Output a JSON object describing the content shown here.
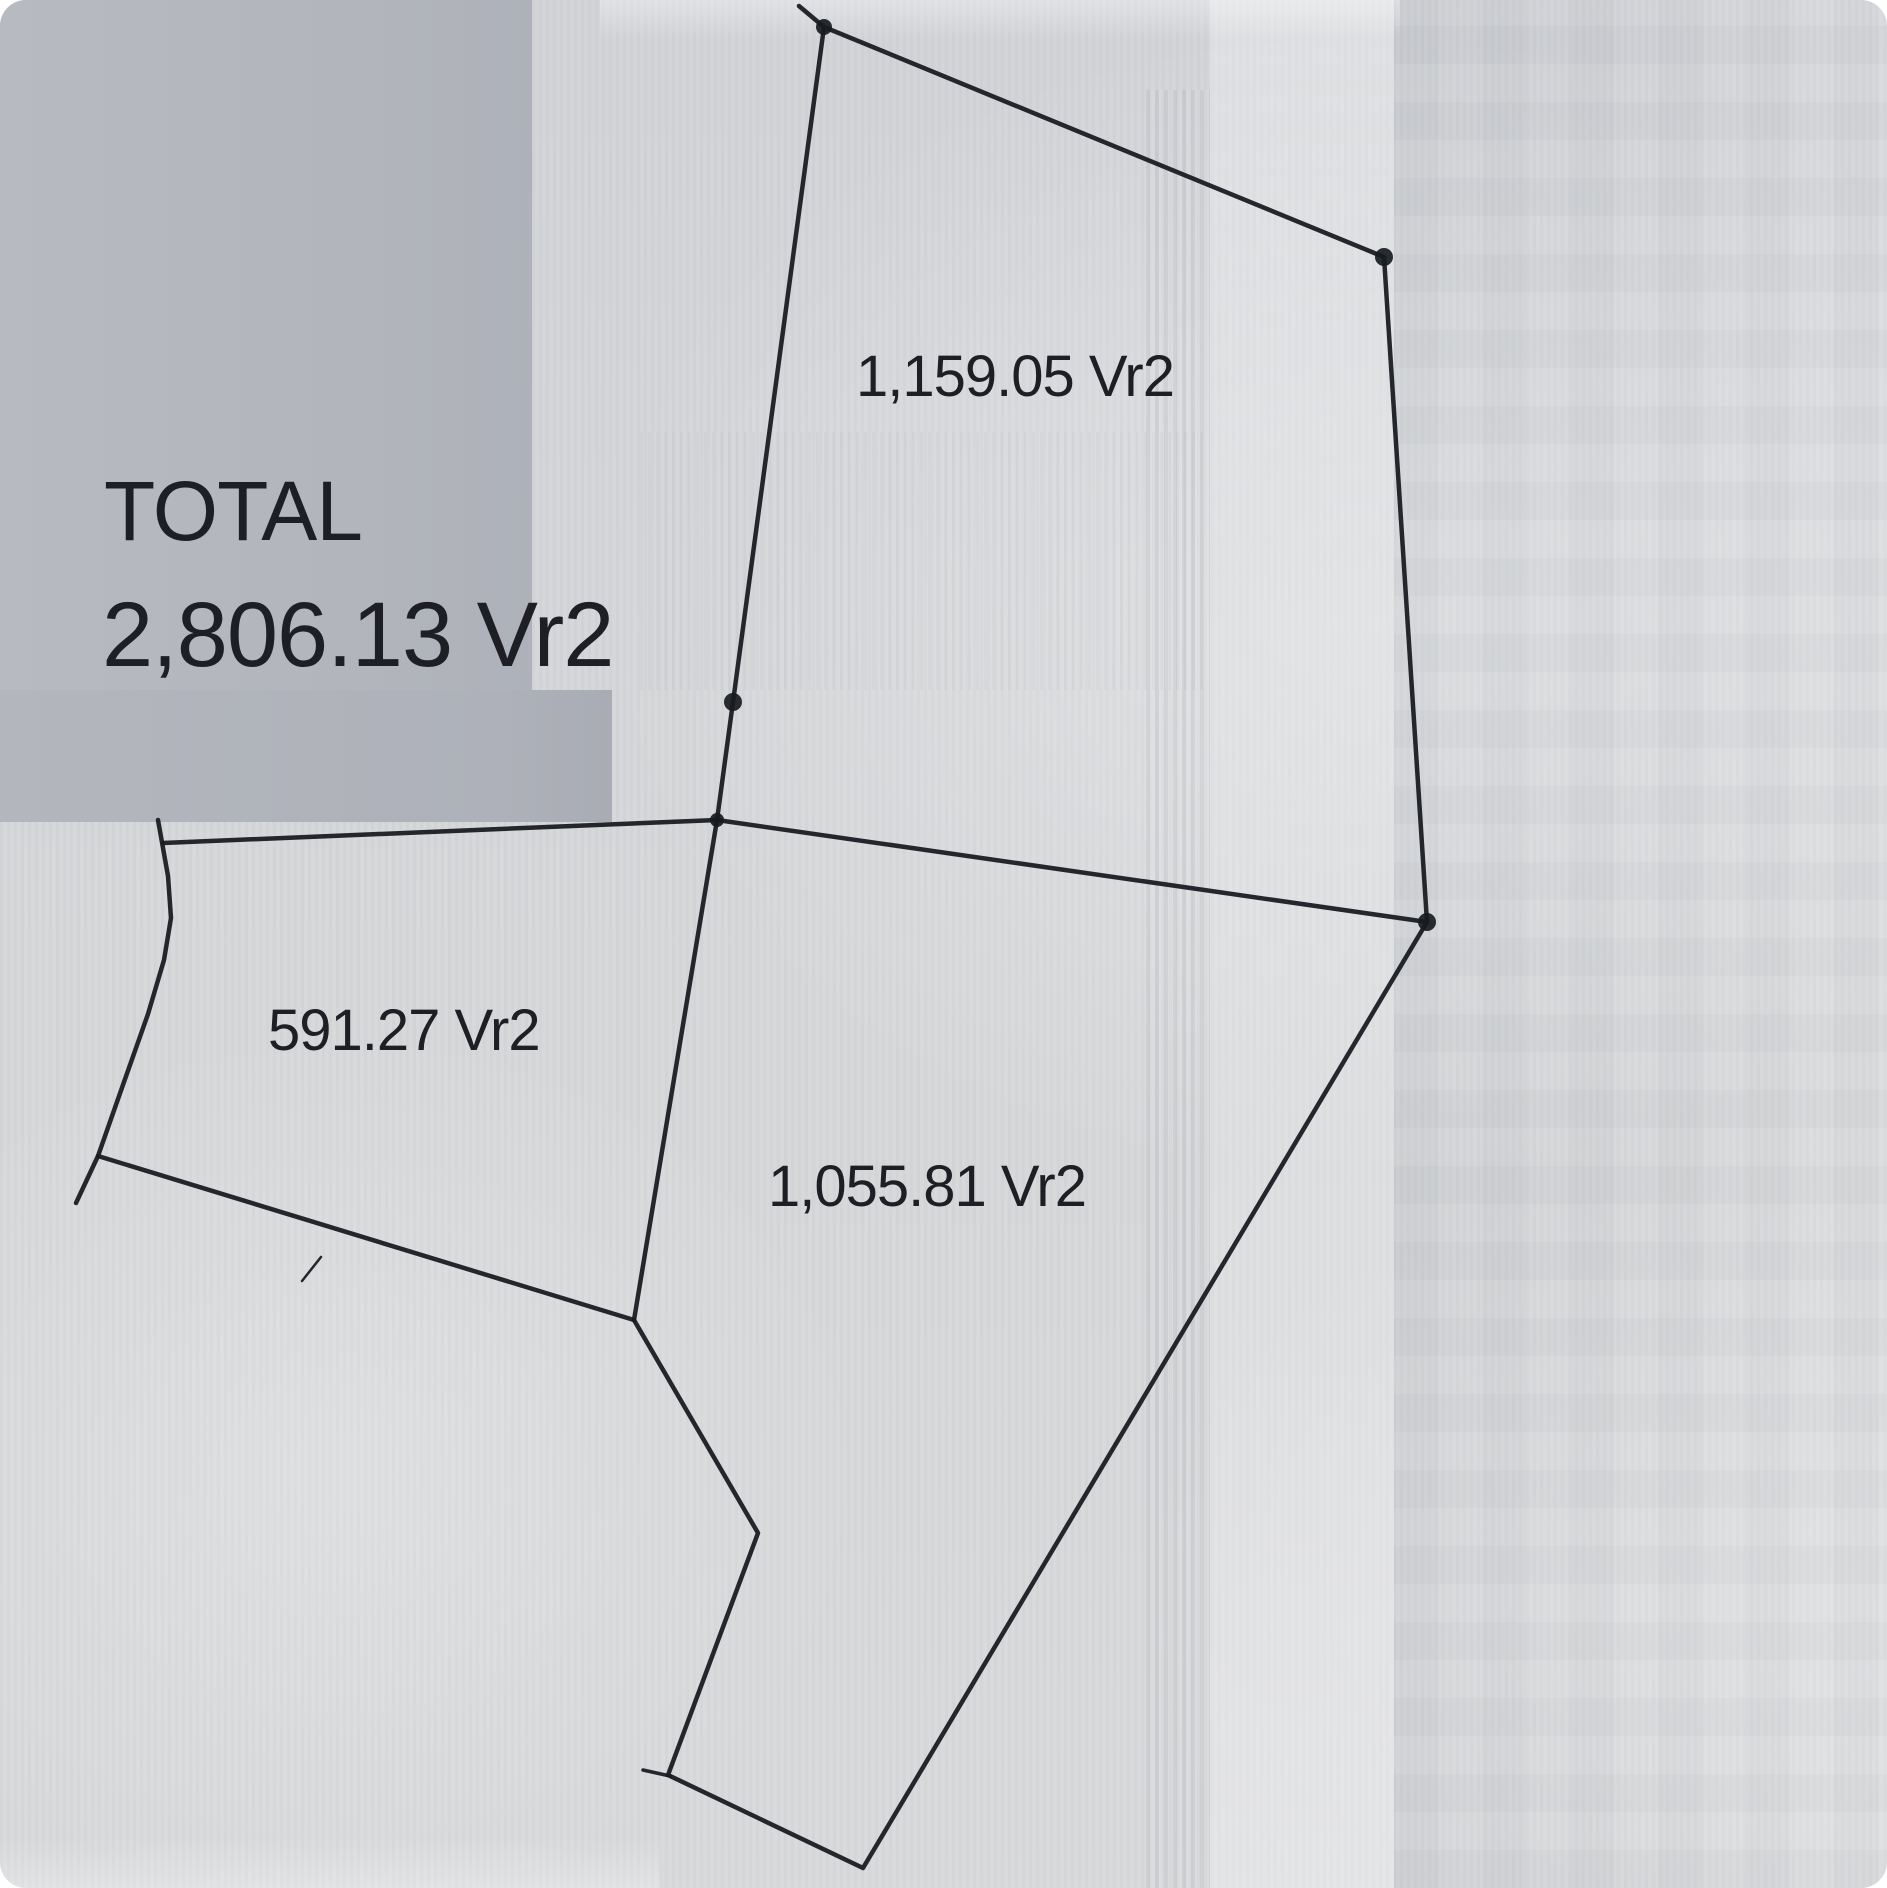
{
  "page_title": "Land survey plat with parcel areas",
  "units": "Vr2",
  "total": {
    "label": "TOTAL",
    "value": "2,806.13 Vr2",
    "area": 2806.13
  },
  "parcels": [
    {
      "id": "north-parcel",
      "area_label": "1,159.05 Vr2",
      "area": 1159.05
    },
    {
      "id": "west-parcel",
      "area_label": "591.27 Vr2",
      "area": 591.27
    },
    {
      "id": "south-parcel",
      "area_label": "1,055.81 Vr2",
      "area": 1055.81
    }
  ],
  "colors": {
    "ink": "#181b21",
    "text": "#1d1f24",
    "paper": "#d5d7d9",
    "patch_gray": "#b2b5bc"
  },
  "survey": {
    "stroke_width": 4.5,
    "polylines": [
      {
        "name": "north-parcel-top-edge",
        "points": [
          [
            799,
            6
          ],
          [
            824,
            27
          ],
          [
            1384,
            257
          ]
        ]
      },
      {
        "name": "north-parcel-right-edge",
        "points": [
          [
            1384,
            257
          ],
          [
            1427,
            922
          ]
        ]
      },
      {
        "name": "north-parcel-left-edge",
        "points": [
          [
            824,
            27
          ],
          [
            733,
            702
          ],
          [
            717,
            820
          ]
        ]
      },
      {
        "name": "mid-horizontal-boundary",
        "points": [
          [
            163,
            843
          ],
          [
            717,
            820
          ],
          [
            1427,
            922
          ]
        ]
      },
      {
        "name": "mid-vertical-boundary",
        "points": [
          [
            717,
            820
          ],
          [
            634,
            1320
          ]
        ]
      },
      {
        "name": "west-curved-boundary",
        "points": [
          [
            158,
            820
          ],
          [
            168,
            876
          ],
          [
            171,
            918
          ],
          [
            164,
            960
          ],
          [
            148,
            1014
          ],
          [
            124,
            1082
          ],
          [
            98,
            1156
          ],
          [
            76,
            1203
          ]
        ]
      },
      {
        "name": "west-parcel-bottom-edge",
        "points": [
          [
            98,
            1156
          ],
          [
            634,
            1320
          ]
        ]
      },
      {
        "name": "south-parcel-outline",
        "points": [
          [
            634,
            1320
          ],
          [
            758,
            1533
          ],
          [
            668,
            1775
          ],
          [
            863,
            1868
          ],
          [
            1427,
            922
          ]
        ]
      },
      {
        "name": "corner-tick",
        "points": [
          [
            643,
            1770
          ],
          [
            670,
            1776
          ]
        ],
        "width": 3.5
      },
      {
        "name": "stray-pen-mark",
        "points": [
          [
            302,
            1281
          ],
          [
            321,
            1257
          ]
        ],
        "width": 2.5
      }
    ],
    "dots": [
      {
        "x": 824,
        "y": 27,
        "r": 8
      },
      {
        "x": 1384,
        "y": 257,
        "r": 9
      },
      {
        "x": 1427,
        "y": 922,
        "r": 9
      },
      {
        "x": 733,
        "y": 702,
        "r": 9
      },
      {
        "x": 717,
        "y": 820,
        "r": 7
      }
    ]
  }
}
